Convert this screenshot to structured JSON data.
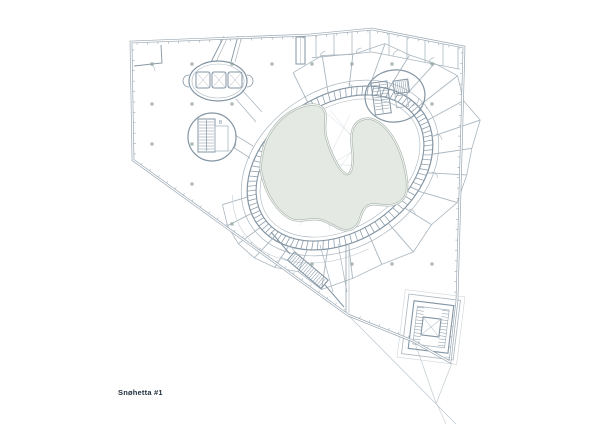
{
  "drawing": {
    "label": "Snøhetta #1",
    "type": "architectural floor plan"
  },
  "colors": {
    "background": "#ffffff",
    "line_main": "#8495a3",
    "line_wall": "#9aa7b2",
    "line_light": "#aab6bf",
    "line_faint": "#ccd4da",
    "site_line": "#c3ccd2",
    "void_fill": "#e4e9e4",
    "void_edge": "#b2bcb5",
    "column": "#8fa39b",
    "label_text": "#22303f"
  }
}
